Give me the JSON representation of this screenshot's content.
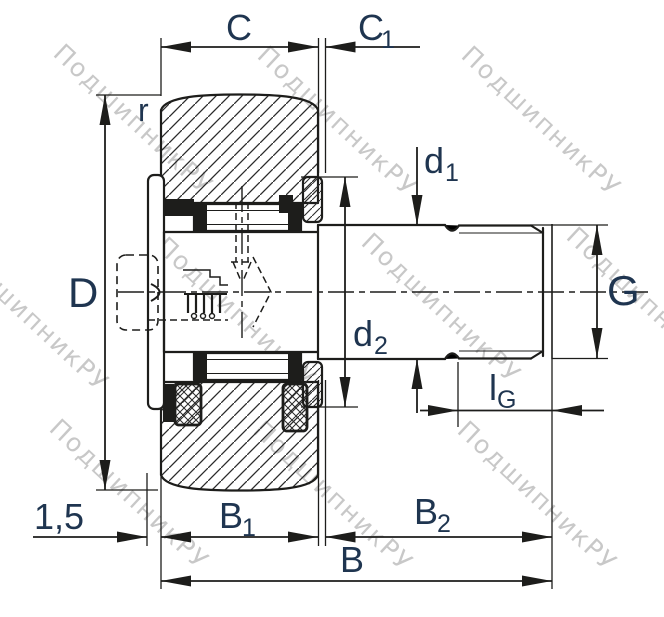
{
  "watermark": {
    "text": "ПодшипникРУ"
  },
  "colors": {
    "line": "#1d1d1b",
    "label": "#1f3550",
    "watermark": "#c8c8c8",
    "background": "#ffffff",
    "hatch": "#2a2a2a"
  },
  "dimensions": {
    "c": {
      "label": "C"
    },
    "c1": {
      "base": "C",
      "sub": "1"
    },
    "r": {
      "label": "r"
    },
    "D": {
      "label": "D"
    },
    "d1": {
      "base": "d",
      "sub": "1"
    },
    "d2": {
      "base": "d",
      "sub": "2"
    },
    "G": {
      "label": "G"
    },
    "lG": {
      "base": "l",
      "sub": "G"
    },
    "b1": {
      "base": "B",
      "sub": "1"
    },
    "b2": {
      "base": "B",
      "sub": "2"
    },
    "b": {
      "label": "B"
    },
    "chamfer": {
      "label": "1,5"
    }
  }
}
